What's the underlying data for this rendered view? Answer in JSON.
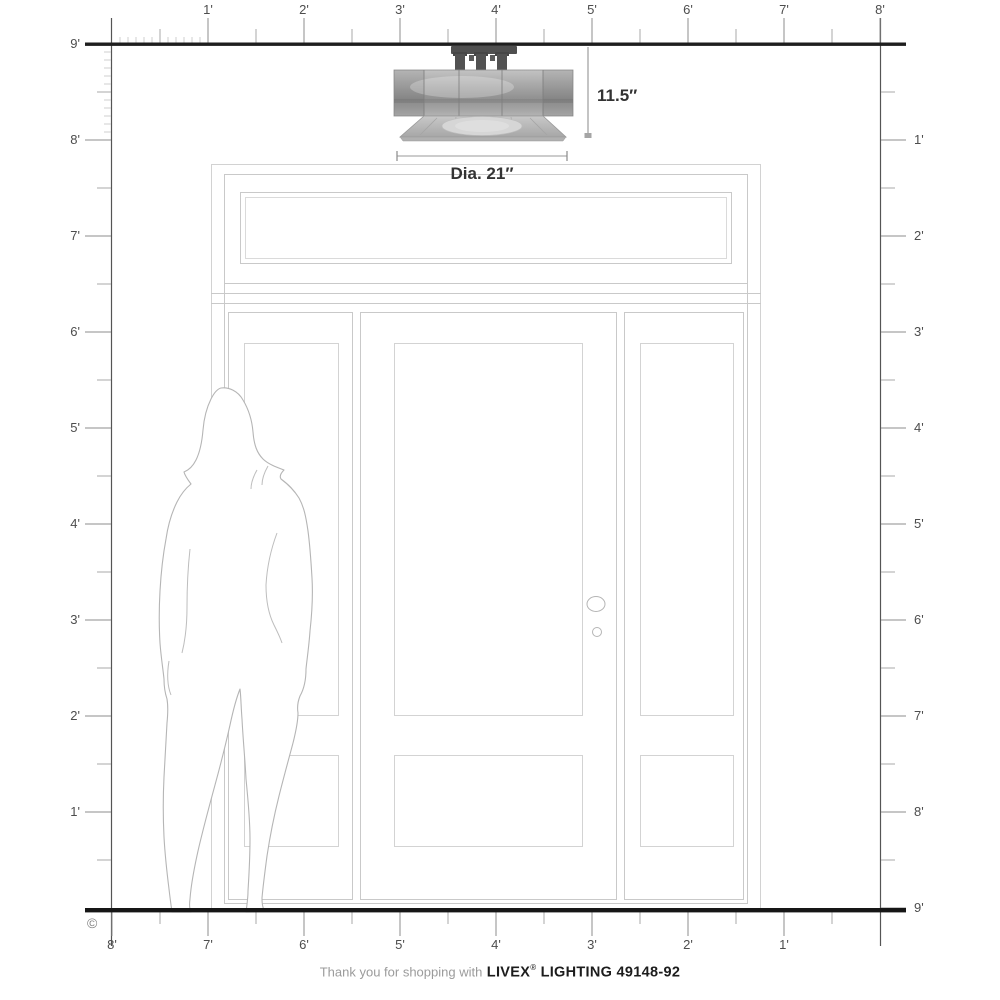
{
  "rulers": {
    "top": [
      "1'",
      "2'",
      "3'",
      "4'",
      "5'",
      "6'",
      "7'",
      "8'"
    ],
    "left": [
      "9'",
      "8'",
      "7'",
      "6'",
      "5'",
      "4'",
      "3'",
      "2'",
      "1'"
    ],
    "right": [
      "1'",
      "2'",
      "3'",
      "4'",
      "5'",
      "6'",
      "7'",
      "8'",
      "9'"
    ],
    "bottom": [
      "8'",
      "7'",
      "6'",
      "5'",
      "4'",
      "3'",
      "2'",
      "1'"
    ]
  },
  "dimensions": {
    "height": "11.5″",
    "diameter": "Dia. 21″"
  },
  "footer": {
    "prefix": "Thank you for shopping with",
    "brand": "LIVEX",
    "registered": "®",
    "suffix": "LIGHTING 49148-92"
  },
  "copyright": "©",
  "colors": {
    "frame_line": "#1e1e1e",
    "tick_major": "#8c8c8c",
    "tick_minor": "#a8a8a8",
    "tick_inch": "#cfcfcf",
    "label_text": "#4d4d4d",
    "door_line": "#cccccc",
    "dimension_text": "#333333"
  }
}
